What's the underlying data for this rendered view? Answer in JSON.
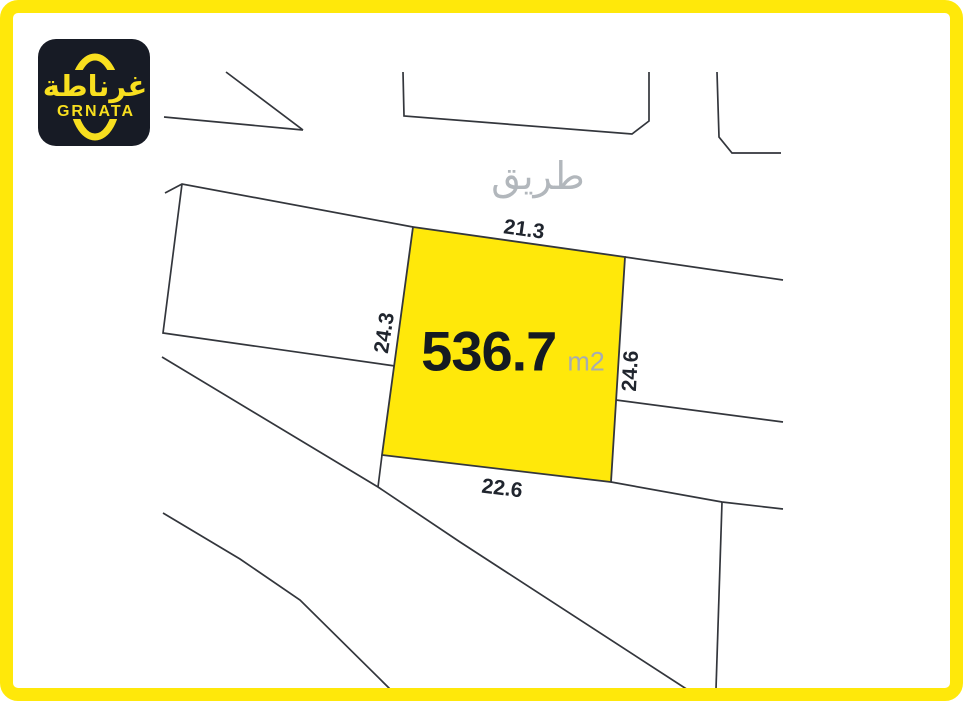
{
  "brand": {
    "logo_arabic": "غرناطة",
    "logo_latin": "GRNATA",
    "logo_bg_color": "#171B25",
    "logo_yellow_color": "#F8DF1F"
  },
  "map": {
    "road_label": "طريق",
    "plot": {
      "area_value": "536.7",
      "area_unit": "m2",
      "dimensions": {
        "top": "21.3",
        "left": "24.3",
        "right": "24.6",
        "bottom": "22.6"
      }
    },
    "colors": {
      "highlight_fill": "#FFE80A",
      "frame_border": "#FFE80A",
      "parcel_outline": "#33363C",
      "area_text": "#151A21",
      "unit_text": "#A7ACB1",
      "road_text": "#B2B7BC",
      "dimension_text": "#20252E"
    }
  }
}
